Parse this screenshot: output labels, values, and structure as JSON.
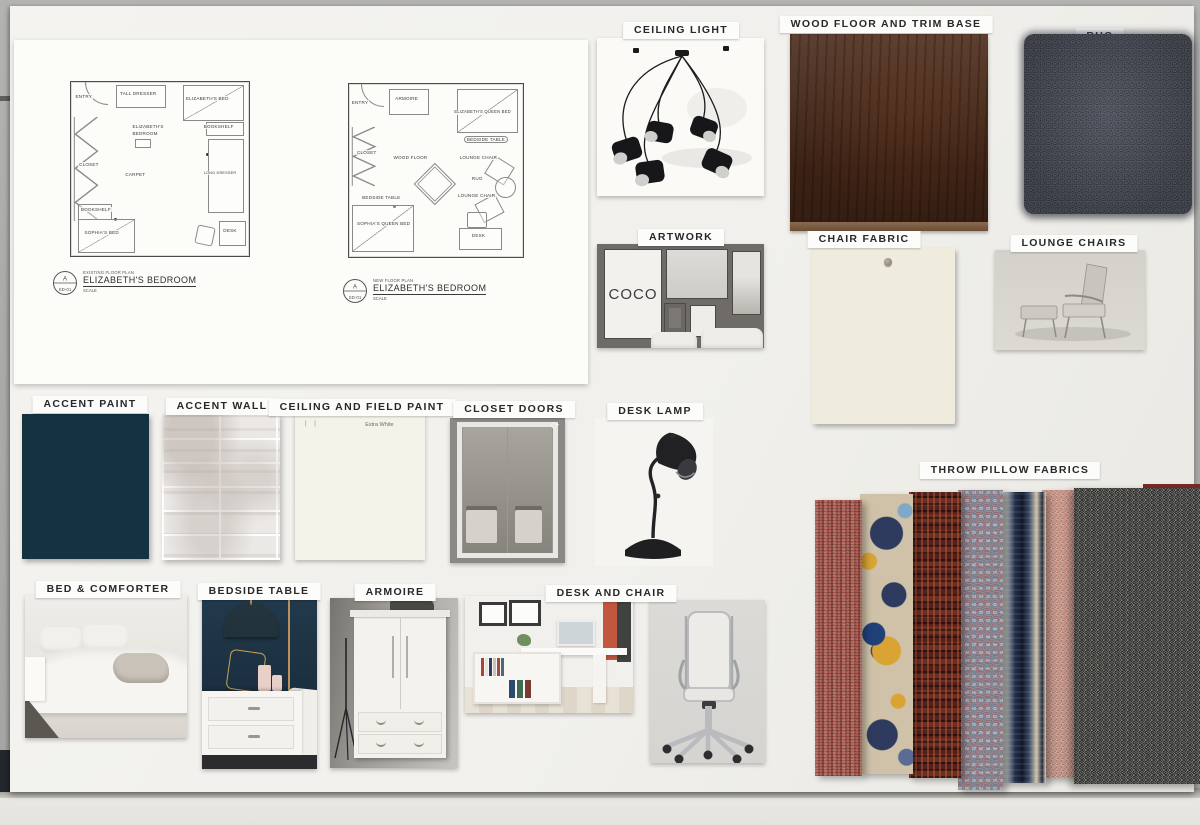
{
  "plan_sheet": {
    "existing": {
      "subtitle": "EXISTING FLOOR PLAN",
      "title": "ELIZABETH'S BEDROOM",
      "scale": "SCALE",
      "mark_letter": "A",
      "mark_sheet": "SD-01",
      "room_tag_line1": "ELIZABETH'S",
      "room_tag_line2": "BEDROOM",
      "items": {
        "entry": "ENTRY",
        "tall_dresser": "TALL DRESSER",
        "elizabeths_bed": "ELIZABETH'S BED",
        "bookshelf_right": "BOOKSHELF",
        "closet": "CLOSET",
        "carpet": "CARPET",
        "long_dresser": "LONG DRESSER",
        "bookshelf_left": "BOOKSHELF",
        "sophias_bed": "SOPHIA'S BED",
        "desk": "DESK"
      }
    },
    "new_plan": {
      "subtitle": "NEW FLOOR PLAN",
      "title": "ELIZABETH'S BEDROOM",
      "scale": "SCALE",
      "mark_letter": "A",
      "mark_sheet": "SD-01",
      "items": {
        "entry": "ENTRY",
        "armoire": "ARMOIRE",
        "elizabeths_queen_bed": "ELIZABETH'S QUEEN BED",
        "closet": "CLOSET",
        "wood_floor": "WOOD FLOOR",
        "bedside_table_right": "BEDSIDE TABLE",
        "lounge_chair_upper": "LOUNGE CHAIR",
        "rug": "RUG",
        "lounge_chair_lower": "LOUNGE CHAIR",
        "bedside_table_left": "BEDSIDE TABLE",
        "sophias_queen_bed": "SOPHIA'S QUEEN BED",
        "desk": "DESK"
      }
    }
  },
  "cards": {
    "ceiling_light": {
      "label": "CEILING LIGHT"
    },
    "wood_floor": {
      "label": "WOOD FLOOR AND TRIM BASE",
      "color": "#4a2a1a"
    },
    "rug": {
      "label": "RUG",
      "color": "#464b58"
    },
    "artwork": {
      "label": "ARTWORK",
      "poster_text": "COCO"
    },
    "chair_fabric": {
      "label": "CHAIR FABRIC",
      "color": "#f0ecdd"
    },
    "lounge_chairs": {
      "label": "LOUNGE CHAIRS"
    },
    "accent_paint": {
      "label": "ACCENT PAINT",
      "color": "#143240"
    },
    "accent_wall": {
      "label": "ACCENT WALL"
    },
    "ceiling_field_paint": {
      "label": "CEILING AND FIELD PAINT",
      "paint_name": "Extra White"
    },
    "closet_doors": {
      "label": "CLOSET DOORS"
    },
    "desk_lamp": {
      "label": "DESK LAMP"
    },
    "bed_comforter": {
      "label": "BED & COMFORTER"
    },
    "bedside_table": {
      "label": "BEDSIDE TABLE"
    },
    "armoire": {
      "label": "ARMOIRE"
    },
    "desk_and_chair": {
      "label": "DESK AND CHAIR"
    },
    "throw_pillows": {
      "label": "THROW PILLOW FABRICS",
      "swatches": [
        {
          "name": "woven-stripe",
          "colors": [
            "#c9bfb2",
            "#8d8377",
            "#a02a24"
          ]
        },
        {
          "name": "floral-medallion",
          "colors": [
            "#cfc2a8",
            "#2e3b5e",
            "#d9a433",
            "#7fa8c9"
          ]
        },
        {
          "name": "basketweave",
          "colors": [
            "#4f221d",
            "#b05a3a"
          ]
        },
        {
          "name": "geometric-lattice",
          "colors": [
            "#b23a2e",
            "#ead9bd",
            "#7d99ad"
          ]
        },
        {
          "name": "ikat-stripe",
          "colors": [
            "#11182a",
            "#d8cdb6",
            "#3a4a63"
          ]
        },
        {
          "name": "speckled-weave",
          "colors": [
            "#a23a30",
            "#ecdfd0"
          ]
        },
        {
          "name": "tweed",
          "colors": [
            "#87867f",
            "#1a1a18",
            "#f0eee9"
          ]
        }
      ]
    }
  }
}
